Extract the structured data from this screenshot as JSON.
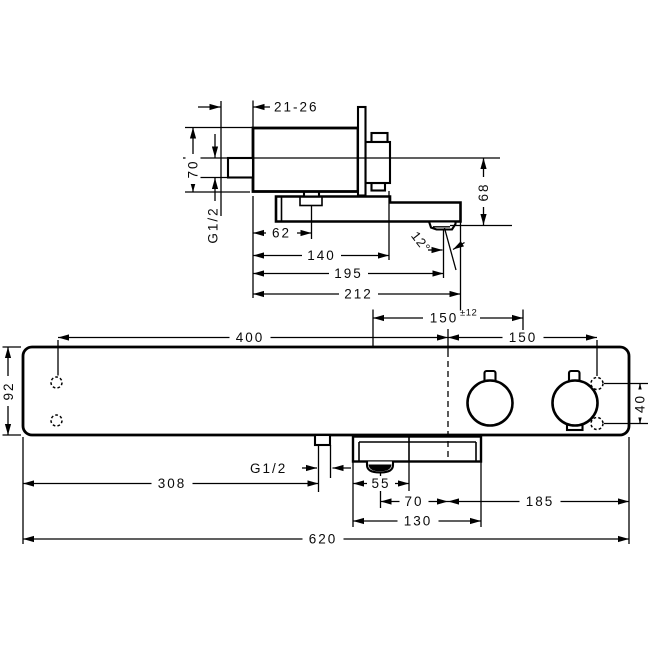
{
  "drawing": {
    "side_view": {
      "labels": {
        "wall_clearance": "21-26",
        "body_height": "70",
        "inlet_thread": "G1/2",
        "dim_62": "62",
        "dim_140": "140",
        "dim_195": "195",
        "dim_212": "212",
        "outlet_drop": "68",
        "outlet_angle": "12°"
      }
    },
    "front_view": {
      "labels": {
        "supply_spacing": "150",
        "supply_tolerance": "±12",
        "center_to_holes": "150",
        "holes_to_center": "400",
        "plate_height": "92",
        "hose_thread": "G1/2",
        "dim_308": "308",
        "dim_55": "55",
        "dim_70": "70",
        "dim_185": "185",
        "dim_130": "130",
        "total_width": "620",
        "hole_spacing": "40"
      }
    }
  }
}
